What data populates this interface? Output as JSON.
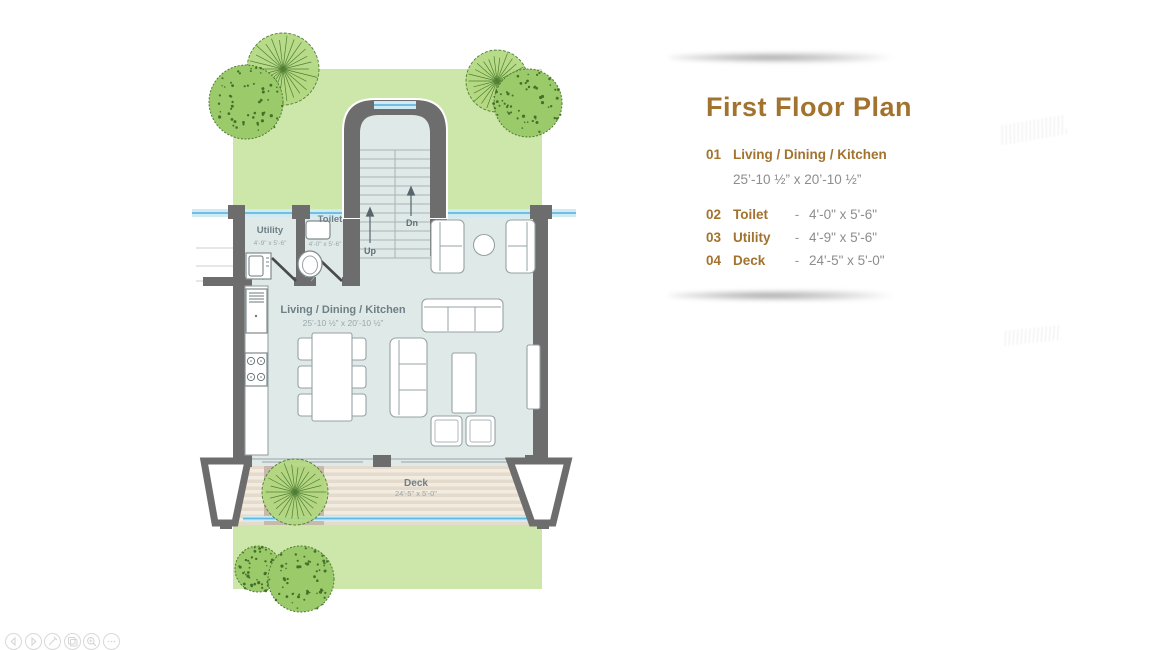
{
  "legend": {
    "title": "First Floor Plan",
    "separator": "-",
    "items": [
      {
        "num": "01",
        "name": "Living / Dining / Kitchen",
        "dims": "25’-10 ½” x 20’-10 ½”"
      },
      {
        "num": "02",
        "name": "Toilet",
        "dims": "4'-0\" x 5'-6\""
      },
      {
        "num": "03",
        "name": "Utility",
        "dims": "4'-9\" x 5'-6\""
      },
      {
        "num": "04",
        "name": "Deck",
        "dims": "24'-5\" x 5'-0\""
      }
    ]
  },
  "plan": {
    "labels": {
      "living": {
        "name": "Living / Dining / Kitchen",
        "dims": "25’-10 ½” x 20’-10 ½”"
      },
      "toilet": {
        "name": "Toilet",
        "dims": "4'-0\" x 5'-6\""
      },
      "utility": {
        "name": "Utility",
        "dims": "4'-9\" x 5'-6\""
      },
      "deck": {
        "name": "Deck",
        "dims": "24'-5\" x 5'-0\""
      },
      "stairs_up": "Up",
      "stairs_down": "Dn"
    }
  },
  "toolbar": {
    "icons": [
      "previous",
      "next",
      "edit",
      "copy",
      "zoom",
      "more"
    ]
  },
  "colors": {
    "wall": "#6d6d6d",
    "floor": "#dfe9e8",
    "lawn": "#cde6a9",
    "deck_light": "#f2ebdf",
    "deck_dark": "#e5dbcc",
    "deck_patch": "#c9b9ac",
    "glass_light": "#cdeaf5",
    "glass_line": "#62b7dc",
    "legend_brown": "#a2732e",
    "legend_gray": "#8d8d8d"
  }
}
